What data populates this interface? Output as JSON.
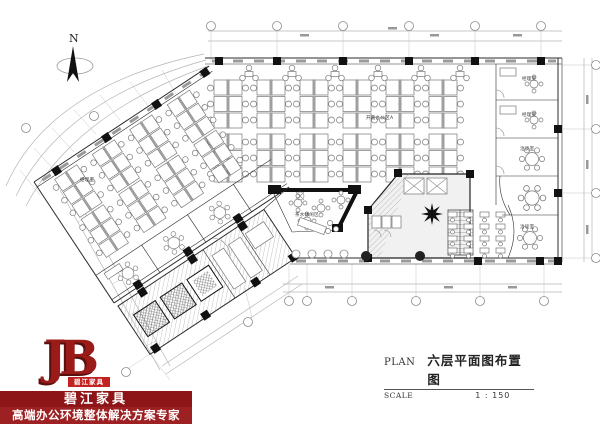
{
  "north": {
    "label": "N"
  },
  "logo": {
    "monogram": "JB",
    "banner": "碧江家具",
    "brand": "碧江家具",
    "tagline": "高端办公环境整体解决方案专家"
  },
  "title_block": {
    "plan_label": "PLAN",
    "title": "六层平面图布置图",
    "scale_label": "SCALE",
    "scale_value": "1 : 150"
  },
  "room_labels": {
    "open_office": "开敞办公区A",
    "manager": "经理室",
    "negotiation": "洽谈室",
    "lounge": "茶水休闲区"
  },
  "colors": {
    "brand_dark_red": "#8e1517",
    "brand_red": "#9d2022",
    "banner_red": "#c32222",
    "wall_black": "#2b2b2b",
    "dim_gray": "#b5b5b5"
  }
}
